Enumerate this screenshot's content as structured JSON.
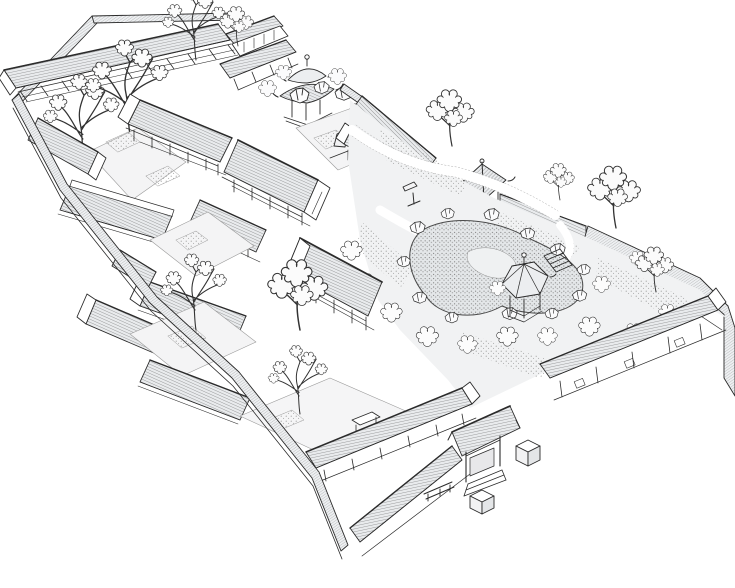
{
  "figure": {
    "description": "Hand-drawn aerial perspective ink illustration of a traditional Chinese siheyuan courtyard residence: tiled-roof halls around paved courtyards on the west half, a landscaped garden with winding gravel paths, a rock-edged pond, a hexagonal pavilion, a square pavilion and covered corridors on the east half, all enclosed by a tiled perimeter wall with an entrance gate, stone bench and stone blocks outside the south-east wall.",
    "medium": "black ink line drawing on white paper",
    "palette": {
      "ink": "#2b2b2b",
      "paper": "#ffffff",
      "roof_shading": "#e9ebed",
      "courtyard_paving": "#f4f4f5",
      "garden_ground": "#f1f2f3",
      "stipple_gray": "#8f8f8f"
    },
    "elements": [
      "perimeter-wall",
      "rear-gallery",
      "two-story-hall",
      "square-pavilion",
      "courtyard-halls",
      "courtyard-trees",
      "garden-paths",
      "garden-pond",
      "rockery",
      "shrubs",
      "hexagonal-pavilion",
      "corner-pavilion",
      "covered-corridor",
      "garden-wall",
      "entrance-gate",
      "gate-steps",
      "stone-bench",
      "stone-blocks"
    ]
  }
}
